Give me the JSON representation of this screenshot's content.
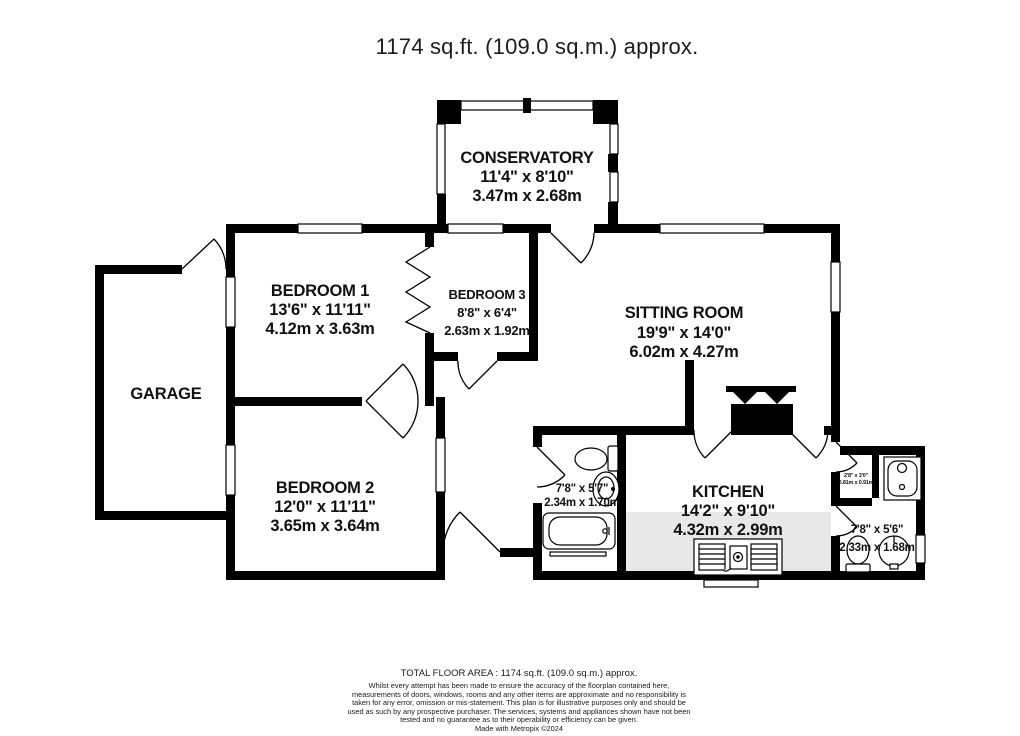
{
  "title": "1174 sq.ft. (109.0 sq.m.) approx.",
  "rooms": {
    "conservatory": {
      "name": "CONSERVATORY",
      "imperial": "11'4\" x 8'10\"",
      "metric": "3.47m x 2.68m"
    },
    "bedroom1": {
      "name": "BEDROOM 1",
      "imperial": "13'6\" x 11'11\"",
      "metric": "4.12m x 3.63m"
    },
    "bedroom3": {
      "name": "BEDROOM 3",
      "imperial": "8'8\" x 6'4\"",
      "metric": "2.63m x 1.92m"
    },
    "sitting_room": {
      "name": "SITTING ROOM",
      "imperial": "19'9\" x 14'0\"",
      "metric": "6.02m x 4.27m"
    },
    "garage": {
      "name": "GARAGE"
    },
    "bedroom2": {
      "name": "BEDROOM 2",
      "imperial": "12'0\" x 11'11\"",
      "metric": "3.65m x 3.64m"
    },
    "bathroom": {
      "imperial": "7'8\" x 5'7\"",
      "metric": "2.34m x 1.70m"
    },
    "kitchen": {
      "name": "KITCHEN",
      "imperial": "14'2\" x 9'10\"",
      "metric": "4.32m x 2.99m"
    },
    "shower_room": {
      "imperial": "7'8\" x 5'6\"",
      "metric": "2.33m x 1.68m"
    },
    "cupboard": {
      "imperial": "2'8\" x 3'0\"",
      "metric": "0.81m x 0.91m"
    }
  },
  "footer": {
    "total_area": "TOTAL FLOOR AREA : 1174 sq.ft. (109.0 sq.m.) approx.",
    "disclaimer": "Whilst every attempt has been made to ensure the accuracy of the floorplan contained here, measurements of doors, windows, rooms and any other items are approximate and no responsibility is taken for any error, omission or mis-statement. This plan is for illustrative purposes only and should be used as such by any prospective purchaser. The services, systems and appliances shown have not been tested and no guarantee as to their operability or efficiency can be given.",
    "credit": "Made with Metropix ©2024"
  },
  "colors": {
    "wall": "#000000",
    "background": "#ffffff",
    "counter": "#e8e8e8",
    "text": "#1a1a1a"
  }
}
